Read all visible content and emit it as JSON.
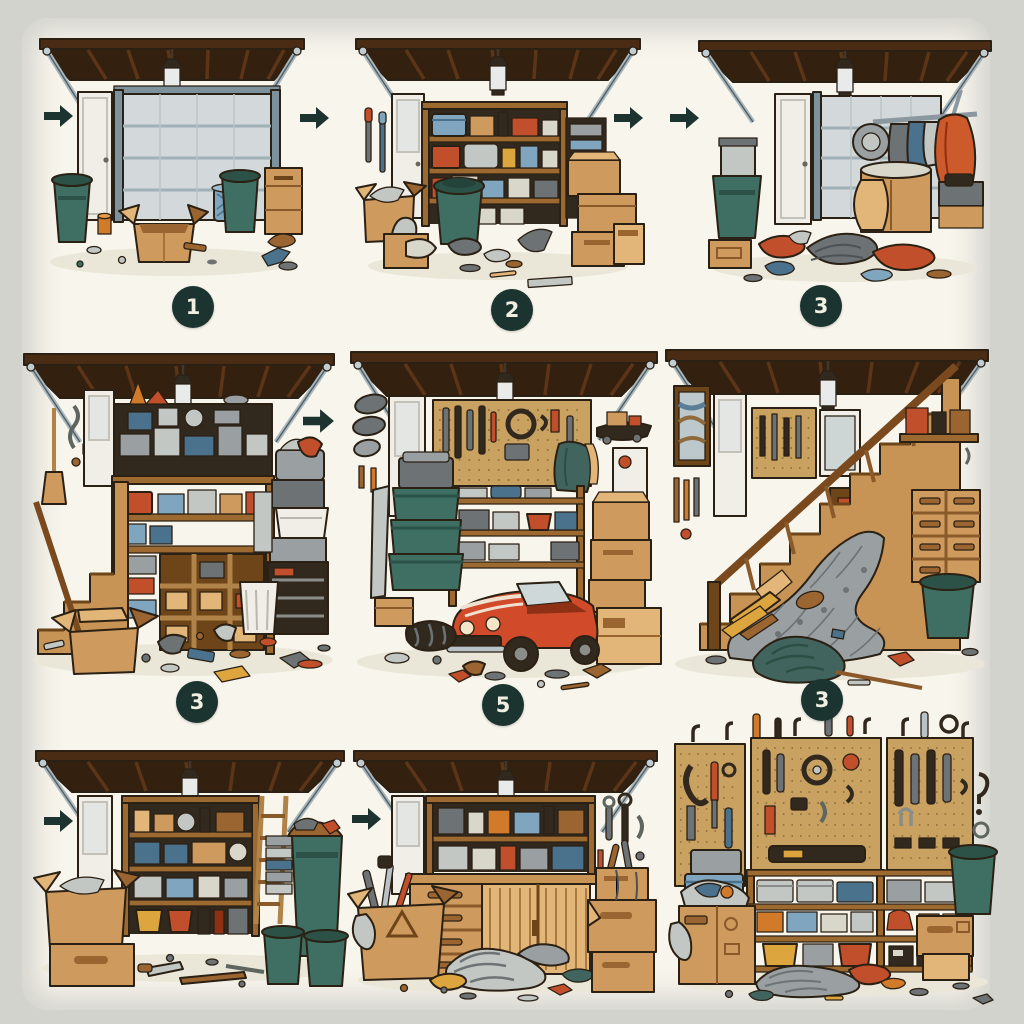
{
  "illustration": {
    "title": "Garage organization sequence — nine hand-drawn comic panels",
    "style": "ink and watercolor style illustration on cream paper with soft gray border",
    "rows": 3,
    "cols": 3
  },
  "badges": [
    {
      "id": "badge-row1-col1",
      "label": "1"
    },
    {
      "id": "badge-row1-col2",
      "label": "2"
    },
    {
      "id": "badge-row1-col3",
      "label": "3"
    },
    {
      "id": "badge-row2-col1",
      "label": "3"
    },
    {
      "id": "badge-row2-col2",
      "label": "5"
    },
    {
      "id": "badge-row2-col3",
      "label": "3"
    }
  ],
  "arrows": [
    {
      "id": "arrow-before-panel-1",
      "direction": "right"
    },
    {
      "id": "arrow-between-panels-1-2",
      "direction": "right"
    },
    {
      "id": "arrow-after-panel-2",
      "direction": "right"
    },
    {
      "id": "arrow-before-panel-3",
      "direction": "right"
    },
    {
      "id": "arrow-between-panels-4-5",
      "direction": "right"
    },
    {
      "id": "arrow-before-panel-7",
      "direction": "right"
    },
    {
      "id": "arrow-before-panel-8",
      "direction": "right"
    }
  ],
  "panels": [
    {
      "name": "mostly-empty-garage",
      "step": "1",
      "items": [
        "open canopy roof with beams and silver struts",
        "hanging ceiling lamp",
        "white side door",
        "closed gray sectional garage door",
        "green trash can left",
        "orange cup",
        "open cardboard box",
        "blue laundry basket",
        "second green trash can",
        "tan cabinet",
        "scattered small debris"
      ]
    },
    {
      "name": "garage-with-stocked-shelves",
      "step": "2",
      "items": [
        "tools hanging on left wall",
        "white side door",
        "wooden shelving with blue and red bins and boxes",
        "green round bin",
        "stacked cardboard boxes",
        "boxes and cloth on floor",
        "scattered clothes"
      ]
    },
    {
      "name": "garage-with-clothes-piles",
      "step": "3",
      "items": [
        "green trash can with small gray bin",
        "cardboard box",
        "white side door",
        "gray sectional door",
        "clothes rack with hanging orange jacket",
        "round fan",
        "tan cabinet",
        "piles of clothes on floor"
      ]
    },
    {
      "name": "cluttered-garage-with-stairs",
      "step": "3",
      "items": [
        "broom and tools on left wall",
        "wooden staircase",
        "packed attic shelf",
        "large wooden shelving with bins and cubbies",
        "orange traffic cone",
        "stack of gray bins and baskets",
        "white trash bin",
        "open cardboard box",
        "debris across floor"
      ]
    },
    {
      "name": "garage-with-red-car",
      "step": "5",
      "items": [
        "oval wall plaques",
        "white side door",
        "pegboard with tools",
        "hanging jacket",
        "skateboard shelf",
        "stacked green totes",
        "wooden shelves with textiles and red bucket",
        "red convertible sports car",
        "stacked cardboard boxes",
        "duffel bag",
        "floor debris"
      ]
    },
    {
      "name": "garage-under-stairs-avalanche",
      "step": "3",
      "items": [
        "framed picture",
        "white door",
        "pegboard",
        "wooden staircase with railing",
        "avalanche of gray clutter under stairs",
        "wall shelf with red books",
        "tan drawer cabinet",
        "green trash can",
        "yellow planks",
        "teal fabric pile",
        "mop handle"
      ]
    },
    {
      "name": "garage-sorted-shelves-and-trash",
      "step": "",
      "items": [
        "white side door",
        "wooden shelving with jugs, crates, blue tote, yellow and red buckets",
        "leaning ladder",
        "stacked gray trays",
        "open cardboard box on closed box",
        "tall green trash can topped with junk",
        "two green trash cans",
        "hand saw and plank on floor"
      ]
    },
    {
      "name": "garage-workbench-and-boxes",
      "step": "",
      "items": [
        "white side door",
        "upper shelves with jars and bins",
        "wooden workbench with drawers and plank doors",
        "open carton with hazard triangle and tools",
        "striped fabric pile",
        "yellow cloth",
        "stacked boxes with tool handles",
        "tools on right wall"
      ]
    },
    {
      "name": "pegboard-wall-organization",
      "step": "",
      "items": [
        "three pegboards full of hanging tools",
        "round gauge",
        "hooks above boards",
        "shelf unit with gray, red, blue, yellow bins",
        "stacked blue bins",
        "overflowing cardboard box",
        "wooden crate",
        "green trash can",
        "clutter pile on floor"
      ]
    }
  ],
  "colors": {
    "border_gray": "#d3d3cd",
    "paper_cream": "#f8f5ec",
    "badge_circle": "#1b3430",
    "badge_text": "#f1eee2",
    "arrow": "#1d3330",
    "roof_brown": "#33200f",
    "strut_silver": "#a9b7bc",
    "trash_green": "#3e6f62",
    "cardboard": "#cf9a5d",
    "bin_blue": "#7fa5bf",
    "bin_red": "#c14f2c",
    "bin_yellow": "#dca53e",
    "car_red": "#d14a2a",
    "pegboard_tan": "#c9a262"
  }
}
